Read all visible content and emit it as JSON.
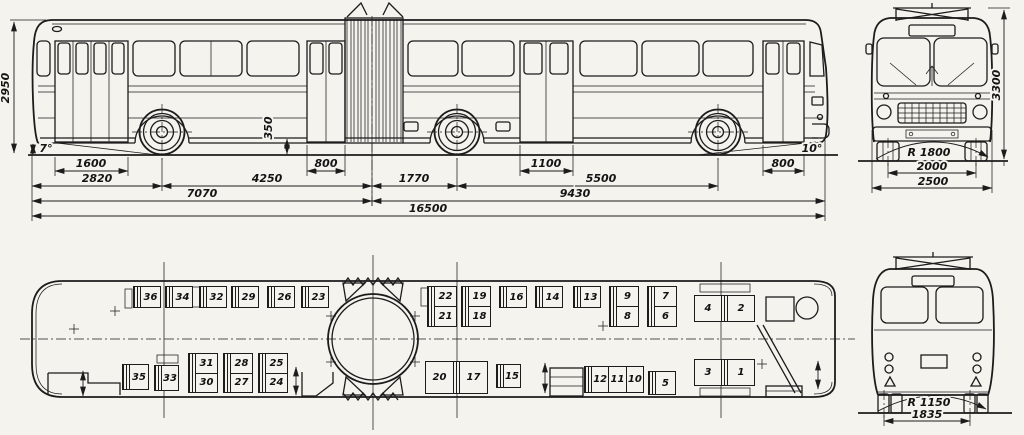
{
  "palette": {
    "paper": "#f5f3ee",
    "ink": "#1c1c1c"
  },
  "side_view": {
    "dims": {
      "overall_height": "2950",
      "approach_angle": "7°",
      "step_height": "350",
      "rear_door_width": "1600",
      "rear_overhang": "2820",
      "rear_axle_to_articulation": "4250",
      "middle_door_width": "800",
      "articulation_to_middle_axle": "1770",
      "trailer_door_width": "1100",
      "middle_to_front_axle": "5500",
      "front_door_width": "800",
      "departure_angle": "10°",
      "rear_section_length": "7070",
      "front_section_length": "9430",
      "overall_length": "16500"
    }
  },
  "front_view": {
    "dims": {
      "overall_height": "3300",
      "turning_radius": "R 1800",
      "track": "2000",
      "overall_width": "2500"
    }
  },
  "rear_view": {
    "dims": {
      "turning_radius": "R 1150",
      "track": "1835"
    }
  },
  "plan_view": {
    "seats": {
      "s1": "1",
      "s2": "2",
      "s3": "3",
      "s4": "4",
      "s5": "5",
      "s6": "6",
      "s7": "7",
      "s8": "8",
      "s9": "9",
      "s10": "10",
      "s11": "11",
      "s12": "12",
      "s13": "13",
      "s14": "14",
      "s15": "15",
      "s16": "16",
      "s17": "17",
      "s18": "18",
      "s19": "19",
      "s20": "20",
      "s21": "21",
      "s22": "22",
      "s23": "23",
      "s24": "24",
      "s25": "25",
      "s26": "26",
      "s27": "27",
      "s28": "28",
      "s29": "29",
      "s30": "30",
      "s31": "31",
      "s32": "32",
      "s33": "33",
      "s34": "34",
      "s35": "35",
      "s36": "36"
    }
  }
}
